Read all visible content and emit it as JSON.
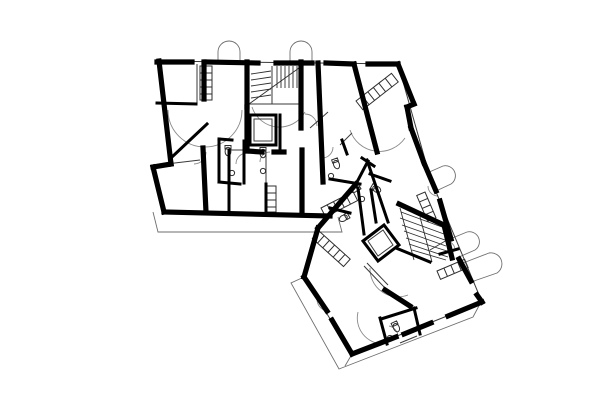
{
  "canvas": {
    "width": 600,
    "height": 400,
    "background": "#ffffff"
  },
  "colors": {
    "wall_ink": "#000000",
    "partition_ink": "#3a3a3a",
    "fixture_ink": "#2f2f2f",
    "swing_ink": "#8a8a8a",
    "balcony_ink": "#6e6e6e"
  },
  "plan": {
    "description": "floor-plan-of-two-apartment-wings",
    "layers": [
      {
        "name": "balcony-outlines",
        "stroke": "#6e6e6e",
        "width": 0.9,
        "cap": "butt",
        "paths": [
          {
            "name": "balcony-arch-top-left",
            "d": "M218,62 V52 A11,11 0 0 1 240,52 V62"
          },
          {
            "name": "balcony-arch-top-right",
            "d": "M290,62 V52 A11,11 0 0 1 312,52 V62"
          },
          {
            "name": "balcony-bump-ne-1",
            "d": "M427,173 L443,166 A10,10 0 0 1 451,184 L436,191"
          },
          {
            "name": "balcony-bump-ne-2",
            "d": "M450,239 L467,232 A10,10 0 0 1 475,250 L459,257"
          },
          {
            "name": "balcony-bump-ne-3",
            "d": "M463,263 L489,253 A11,11 0 0 1 497,273 L471,282"
          },
          {
            "name": "balcony-strip-south",
            "d": "M153,212 L158,232 L342,232 L338,217"
          },
          {
            "name": "balcony-strip-southwest",
            "d": "M304,277 L291,283 L339,369 L473,317 L481,302"
          },
          {
            "name": "balcony-strip-tick",
            "d": "M352,354 L345,366"
          }
        ]
      },
      {
        "name": "door-swings",
        "stroke": "#8a8a8a",
        "width": 0.9,
        "cap": "butt",
        "paths": [
          {
            "name": "swing-arc-left-room",
            "d": "M168,110 A37,37 0 0 0 242,110"
          },
          {
            "name": "swing-arc-mid-room",
            "d": "M252,107 A29,29 0 0 0 305,112"
          },
          {
            "name": "swing-arc-right-room",
            "d": "M350,130 A31,31 0 0 0 405,138"
          },
          {
            "name": "swing-arc-lower-living",
            "d": "M370,268 A28,28 0 0 0 408,295"
          },
          {
            "name": "swing-arc-lower-bath-area",
            "d": "M358,312 A26,26 0 0 0 383,344"
          },
          {
            "name": "door-swing",
            "d": "M206,152 A12,12 0 0 1 194,164"
          },
          {
            "name": "door-swing",
            "d": "M305,114 A12,12 0 0 1 317,126"
          },
          {
            "name": "door-swing",
            "d": "M247,153 A11,11 0 0 0 236,164"
          },
          {
            "name": "door-swing",
            "d": "M333,147 A11,11 0 0 1 322,158"
          },
          {
            "name": "door-swing",
            "d": "M438,196 A10,10 0 0 1 428,186"
          },
          {
            "name": "door-swing",
            "d": "M398,337 A11,11 0 0 0 389,326"
          },
          {
            "name": "door-swing",
            "d": "M455,250 A9,9 0 0 0 446,241"
          },
          {
            "name": "door-swing",
            "d": "M327,311 A12,12 0 0 1 317,299"
          },
          {
            "name": "door-swing",
            "d": "M270,152 A10,10 0 0 0 260,162"
          }
        ]
      },
      {
        "name": "thin-partitions",
        "stroke": "#3a3a3a",
        "width": 1,
        "cap": "butt",
        "paths": [
          {
            "name": "facade-face-line-top",
            "d": "M157,61 L398,64"
          },
          {
            "name": "facade-face-line-right",
            "d": "M398,64 L428,170"
          },
          {
            "name": "facade-face-line-northeast",
            "d": "M424,163 L482,302"
          },
          {
            "name": "facade-face-line-southeast",
            "d": "M482,302 L352,354"
          },
          {
            "name": "facade-face-line-southwest",
            "d": "M352,354 L304,277"
          },
          {
            "name": "partition",
            "d": "M197,64 V103"
          },
          {
            "name": "partition",
            "d": "M158,165 L200,160"
          },
          {
            "name": "partition",
            "d": "M230,150 L266,150"
          },
          {
            "name": "partition",
            "d": "M266,150 V184"
          },
          {
            "name": "corridor-glazing-1",
            "d": "M364,266 L385,288"
          },
          {
            "name": "corridor-glazing-2",
            "d": "M367,263 L388,285"
          },
          {
            "name": "partition",
            "d": "M417,336 L400,343"
          },
          {
            "name": "partition",
            "d": "M447,240 L430,250"
          },
          {
            "name": "door-leaf",
            "d": "M310,128 L328,112"
          },
          {
            "name": "door-leaf",
            "d": "M340,145 L352,133"
          },
          {
            "name": "elevator-upper-inner-frame",
            "d": "M254,119 h18 v22 h-18 Z"
          },
          {
            "name": "elevator-lower-inner-frame",
            "d": "M368,241 L383,230 L393,245 L378,256 Z"
          },
          {
            "name": "stair-upper-mid-line",
            "d": "M272,66 V104"
          },
          {
            "name": "stair-upper-edge",
            "d": "M249,65 V104"
          },
          {
            "name": "stair-upper-edge",
            "d": "M249,104 H301"
          }
        ]
      },
      {
        "name": "stair-treads",
        "stroke": "#2f2f2f",
        "width": 0.9,
        "cap": "butt",
        "paths": [
          {
            "name": "stair-upper-treads-right-flight",
            "d": "M277,66 V88 M281,66 V88 M285,66 V88 M289,66 V88 M293,66 V88 M297,66 V88"
          },
          {
            "name": "stair-upper-treads-left-flight",
            "d": "M251,74 L271,71 M251,80 L271,77 M251,86 L271,83 M251,92 L271,89 M251,98 L271,95"
          },
          {
            "name": "stair-upper-divider",
            "d": "M249,104 L299,68"
          },
          {
            "name": "stair-lower-treads",
            "d": "M401,212 L442,227 M400,218 L444,234 M402,225 L445,240 M404,231 L446,246 M406,238 L447,251 M409,244 L448,257 M412,250 L446,260"
          },
          {
            "name": "stair-lower-edge",
            "d": "M400,208 L414,260"
          },
          {
            "name": "stair-lower-edge",
            "d": "M420,217 L432,262"
          }
        ]
      },
      {
        "name": "fixtures",
        "stroke": "#2f2f2f",
        "width": 1,
        "cap": "butt",
        "paths": [
          {
            "name": "wardrobe-left",
            "d": "M200,66 h12 v34 h-12 Z M200,73 h12 M200,80 h12 M200,87 h12 M200,94 h12"
          },
          {
            "name": "wardrobe-corridor",
            "d": "M267,186 h9 v26 h-9 Z M267,193 h9 M267,200 h9 M267,207 h9"
          },
          {
            "name": "kitchen-counter-upper-right",
            "t": "translate(356,101) rotate(-38)",
            "d": "M0,0 h45 v11 h-45 Z M8,0 v11 M15,0 v11 M22,0 v11 M29,0 v11 M37,0 v11"
          },
          {
            "name": "kitchen-counter-lower-west",
            "t": "translate(319,231) rotate(42)",
            "d": "M0,0 h42 v10 h-42 Z M7,0 v10 M14,0 v10 M21,0 v10 M28,0 v10 M35,0 v10"
          },
          {
            "name": "kitchen-counter-lower-east",
            "t": "translate(437,271) rotate(-23)",
            "d": "M0,0 h30 v9 h-30 Z M7.5,0 v9 M15,0 v9 M22.5,0 v9"
          },
          {
            "name": "kitchen-counter-junction",
            "t": "translate(321,208) rotate(-27)",
            "d": "M0,0 h36 v10 h-36 Z M7,0 v10 M14,0 v10 M21,0 v10 M28,0 v10"
          },
          {
            "name": "kitchen-counter-lower-north",
            "t": "translate(425,192) rotate(67)",
            "d": "M0,0 h28 v9 h-28 Z M7,0 v9 M14,0 v9 M21,0 v9"
          },
          {
            "name": "toilet",
            "t": "translate(228,153)",
            "d": "M-3,-7.5 h6 v3.5 h-6 Z M-2.9,-1.5 a2.9,4.3 0 1 0 5.8,0 a2.9,4.3 0 1 0 -5.8,0"
          },
          {
            "name": "toilet",
            "t": "translate(263,155)",
            "d": "M-3,-7.5 h6 v3.5 h-6 Z M-2.9,-1.5 a2.9,4.3 0 1 0 5.8,0 a2.9,4.3 0 1 0 -5.8,0"
          },
          {
            "name": "toilet",
            "t": "translate(337,166) rotate(-20)",
            "d": "M-3,-7.5 h6 v3.5 h-6 Z M-2.9,-1.5 a2.9,4.3 0 1 0 5.8,0 a2.9,4.3 0 1 0 -5.8,0"
          },
          {
            "name": "toilet",
            "t": "translate(353,190) rotate(60)",
            "d": "M-3,-7.5 h6 v3.5 h-6 Z M-2.9,-1.5 a2.9,4.3 0 1 0 5.8,0 a2.9,4.3 0 1 0 -5.8,0"
          },
          {
            "name": "toilet",
            "t": "translate(378,190) rotate(-60)",
            "d": "M-3,-7.5 h6 v3.5 h-6 Z M-2.9,-1.5 a2.9,4.3 0 1 0 5.8,0 a2.9,4.3 0 1 0 -5.8,0"
          },
          {
            "name": "toilet",
            "t": "translate(397,329) rotate(-25)",
            "d": "M-3,-7.5 h6 v3.5 h-6 Z M-2.9,-1.5 a2.9,4.3 0 1 0 5.8,0 a2.9,4.3 0 1 0 -5.8,0"
          },
          {
            "name": "toilet",
            "t": "translate(342,219) rotate(60)",
            "d": "M-3,-7.5 h6 v3.5 h-6 Z M-2.9,-1.5 a2.9,4.3 0 1 0 5.8,0 a2.9,4.3 0 1 0 -5.8,0"
          },
          {
            "name": "sink",
            "t": "translate(232,173)",
            "d": "M-2.6,0 a2.6,2.6 0 1 0 5.2,0 a2.6,2.6 0 1 0 -5.2,0"
          },
          {
            "name": "sink",
            "t": "translate(263,171)",
            "d": "M-2.6,0 a2.6,2.6 0 1 0 5.2,0 a2.6,2.6 0 1 0 -5.2,0"
          },
          {
            "name": "sink",
            "t": "translate(331,176)",
            "d": "M-2.6,0 a2.6,2.6 0 1 0 5.2,0 a2.6,2.6 0 1 0 -5.2,0"
          },
          {
            "name": "sink",
            "t": "translate(362,199)",
            "d": "M-2.6,0 a2.6,2.6 0 1 0 5.2,0 a2.6,2.6 0 1 0 -5.2,0"
          },
          {
            "name": "sink",
            "t": "translate(390,338)",
            "d": "M-2.6,0 a2.6,2.6 0 1 0 5.2,0 a2.6,2.6 0 1 0 -5.2,0"
          }
        ]
      },
      {
        "name": "medium-walls",
        "stroke": "#000000",
        "width": 3,
        "cap": "square",
        "paths": [
          {
            "name": "wall",
            "d": "M157,103 L196,104"
          },
          {
            "name": "bath-wall",
            "d": "M219,139 V182"
          },
          {
            "name": "bath-wall",
            "d": "M244,141 V183"
          },
          {
            "name": "bath-wall",
            "d": "M219,139 L232,140"
          },
          {
            "name": "bath-wall",
            "d": "M219,182 L240,184"
          },
          {
            "name": "wall",
            "d": "M229,150 V213"
          },
          {
            "name": "wall",
            "d": "M280,115 V152"
          },
          {
            "name": "elevator-upper-shaft",
            "d": "M250,115 h26 v30 h-26 Z"
          },
          {
            "name": "elevator-lower-shaft",
            "d": "M363,241 L384,225 L399,245 L378,261 Z"
          },
          {
            "name": "junction-bath-wall",
            "d": "M342,140 L347,154"
          },
          {
            "name": "junction-bath-wall",
            "d": "M362,158 L374,166"
          },
          {
            "name": "junction-bath-wall",
            "d": "M367,160 L388,222"
          },
          {
            "name": "junction-bath-wall",
            "d": "M330,179 L360,184"
          },
          {
            "name": "junction-bath-wall",
            "d": "M370,174 L390,181"
          },
          {
            "name": "junction-bath-wall",
            "d": "M371,190 L376,222"
          },
          {
            "name": "junction-bath-wall",
            "d": "M330,208 L350,213"
          },
          {
            "name": "junction-wall",
            "d": "M356,184 L368,161"
          },
          {
            "name": "junction-wall",
            "d": "M358,188 L364,234"
          },
          {
            "name": "lower-stair-wall",
            "d": "M396,248 L430,262"
          },
          {
            "name": "lower-bath-wall",
            "d": "M381,319 L416,308"
          },
          {
            "name": "lower-bath-wall",
            "d": "M380,318 L387,344"
          },
          {
            "name": "lower-bath-wall",
            "d": "M414,308 L420,334"
          },
          {
            "name": "left-room-diagonal-wall",
            "d": "M172,157 L207,124"
          },
          {
            "name": "lower-kitchen-wall",
            "d": "M440,254 L458,249"
          },
          {
            "name": "wall",
            "d": "M266,184 V213"
          }
        ]
      },
      {
        "name": "thick-walls",
        "stroke": "#000000",
        "width": 5.2,
        "cap": "square",
        "paths": [
          {
            "name": "exterior-wall-top",
            "d": "M157,62 L192,62"
          },
          {
            "name": "exterior-wall-top",
            "d": "M206,62 L258,63"
          },
          {
            "name": "exterior-wall-top",
            "d": "M276,63 L312,63"
          },
          {
            "name": "exterior-wall-top",
            "d": "M326,63 L354,64"
          },
          {
            "name": "exterior-wall-top",
            "d": "M368,64 L398,64"
          },
          {
            "name": "exterior-wall-left",
            "d": "M159,61 L171,164"
          },
          {
            "name": "exterior-wall-left-jog",
            "d": "M171,164 L153,167"
          },
          {
            "name": "exterior-wall-left-lower",
            "d": "M153,167 L164,212"
          },
          {
            "name": "exterior-wall-bottom",
            "d": "M164,212 L330,216"
          },
          {
            "name": "exterior-wall-right-diagonal",
            "d": "M398,64 L414,104"
          },
          {
            "name": "exterior-wall-notch",
            "d": "M414,104 L407,107"
          },
          {
            "name": "exterior-wall-notch",
            "d": "M407,107 L411,128"
          },
          {
            "name": "exterior-wall-right-diagonal",
            "d": "M411,128 L424,163"
          },
          {
            "name": "exterior-wall-northeast",
            "d": "M424,163 L436,191"
          },
          {
            "name": "exterior-wall-northeast",
            "d": "M440,201 L451,239"
          },
          {
            "name": "exterior-wall-northeast",
            "d": "M459,259 L471,281"
          },
          {
            "name": "exterior-wall-northeast",
            "d": "M477,295 L482,302"
          },
          {
            "name": "exterior-wall-southeast",
            "d": "M482,302 L448,316"
          },
          {
            "name": "exterior-wall-southeast",
            "d": "M431,323 L404,334"
          },
          {
            "name": "exterior-wall-southeast",
            "d": "M396,337 L352,354"
          },
          {
            "name": "exterior-wall-southwest",
            "d": "M352,354 L332,320"
          },
          {
            "name": "exterior-wall-southwest",
            "d": "M327,311 L304,277"
          },
          {
            "name": "exterior-wall-northwest",
            "d": "M304,277 L318,228"
          },
          {
            "name": "party-wall-diagonal",
            "d": "M318,228 L356,184"
          },
          {
            "name": "stair-core-wall",
            "d": "M247,62 V107"
          },
          {
            "name": "stair-core-wall",
            "d": "M301,62 V128"
          },
          {
            "name": "elevator-side-wall",
            "d": "M247,107 V151"
          },
          {
            "name": "interior-wall",
            "d": "M247,151 L262,152"
          },
          {
            "name": "interior-wall",
            "d": "M274,152 L284,152"
          },
          {
            "name": "interior-wall-long",
            "d": "M318,63 L323,182"
          },
          {
            "name": "interior-wall-diagonal",
            "d": "M354,64 L377,152"
          },
          {
            "name": "interior-wall",
            "d": "M204,62 V99"
          },
          {
            "name": "interior-wall",
            "d": "M203,148 L206,212"
          },
          {
            "name": "interior-wall",
            "d": "M302,150 V214"
          },
          {
            "name": "lower-stair-wall",
            "d": "M399,204 L444,225"
          },
          {
            "name": "lower-stair-wall",
            "d": "M444,225 L452,258"
          },
          {
            "name": "lower-interior-wall",
            "d": "M385,290 L410,306"
          }
        ]
      }
    ]
  }
}
